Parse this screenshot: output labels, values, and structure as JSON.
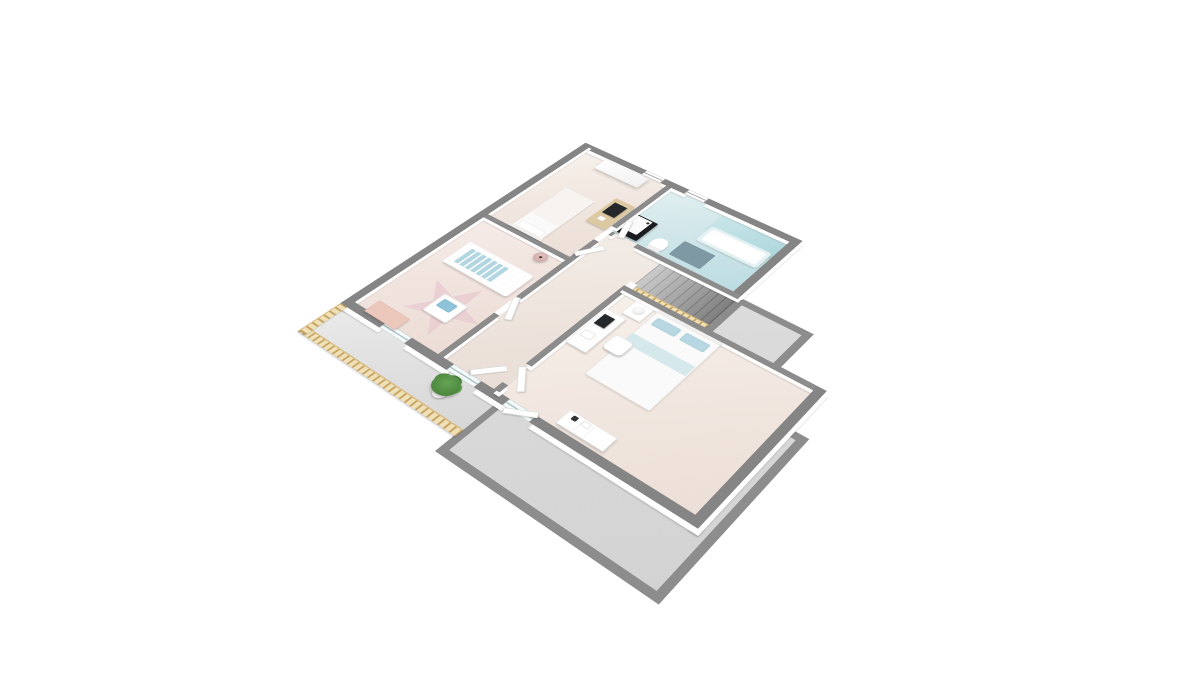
{
  "meta": {
    "description": "3D isometric rendering of an upper-storey floor plan on a white background, rotated ~40 degrees, with gray-topped white walls",
    "background_color": "#ffffff",
    "visible_text": []
  },
  "palette": {
    "wall_top": "#8c8c8c",
    "wall_face": "#ffffff",
    "warm_floor": "#f3e9e2",
    "bathroom_floor": "#c9e2e6",
    "bath_mat": "#7e99a4",
    "glass_screen": "#b8dde2",
    "terrace_floor": "#dedede",
    "railing_wood": "#e8d6ab",
    "rug_pink": "#e9ccd1",
    "bedding_blue": "#b7d8e2",
    "vanity_black": "#1a1c1f",
    "plant_green": "#4c8a3f"
  },
  "rooms": [
    {
      "name": "bedroom-1",
      "position": "top-left",
      "furniture": [
        "single-bed",
        "wardrobe",
        "wood-desk",
        "computer",
        "floor-lamp"
      ]
    },
    {
      "name": "bathroom",
      "position": "top-right",
      "furniture": [
        "bathtub",
        "glass-screen",
        "black-vanity-with-sink",
        "bath-mat",
        "toilet"
      ]
    },
    {
      "name": "nursery",
      "position": "left",
      "furniture": [
        "crib",
        "star-rug",
        "toy-basket",
        "pink-dresser"
      ]
    },
    {
      "name": "landing",
      "position": "center",
      "furniture": [
        "staircase",
        "stair-railing",
        "open-doors"
      ]
    },
    {
      "name": "bedroom-2",
      "position": "bottom-right",
      "furniture": [
        "double-bed",
        "blue-pillows",
        "nightstand",
        "table-lamp",
        "white-desk",
        "desk-chair",
        "sideboard"
      ]
    },
    {
      "name": "balcony",
      "position": "bottom-left",
      "furniture": [
        "wood-railing",
        "potted-plant"
      ]
    },
    {
      "name": "lower-terrace",
      "position": "bottom-right-outside",
      "furniture": []
    }
  ],
  "elements": [
    {
      "k": "terrace-border",
      "name": "terrace-parapet",
      "x": 0,
      "y": 0,
      "w": 680,
      "h": 640
    },
    {
      "k": "terrace-floor",
      "name": "terrace-floor",
      "x": 0,
      "y": 0,
      "w": 680,
      "h": 640
    },
    {
      "k": "floor-balcony",
      "name": "balcony-floor",
      "x": 0,
      "y": 524,
      "w": 302,
      "h": 72
    },
    {
      "k": "floor-warm",
      "name": "bedroom1-floor",
      "x": 14,
      "y": 14,
      "w": 166,
      "h": 232
    },
    {
      "k": "floor-bath",
      "name": "bathroom-floor",
      "x": 190,
      "y": 14,
      "w": 220,
      "h": 146
    },
    {
      "k": "floor-landing",
      "name": "landing-floor",
      "x": 190,
      "y": 160,
      "w": 102,
      "h": 350
    },
    {
      "k": "floor-warm2",
      "name": "nursery-floor",
      "x": 14,
      "y": 246,
      "w": 166,
      "h": 264
    },
    {
      "k": "floor-warm",
      "name": "bedroom2-floor",
      "x": 292,
      "y": 256,
      "w": 308,
      "h": 254
    },
    {
      "k": "stairs",
      "name": "staircase",
      "x": 292,
      "y": 172,
      "w": 132,
      "h": 66
    },
    {
      "k": "rail",
      "name": "stair-railing",
      "x": 292,
      "y": 238,
      "w": 132,
      "h": 9
    },
    {
      "k": "newel",
      "name": "stair-newel-post",
      "x": 284,
      "y": 234,
      "w": 13,
      "h": 14
    },
    {
      "k": "glass",
      "name": "bathtub-glass-screen",
      "x": 296,
      "y": 8,
      "w": 118,
      "h": 54
    },
    {
      "k": "tub",
      "name": "bathtub",
      "x": 298,
      "y": 54,
      "w": 108,
      "h": 44
    },
    {
      "k": "mat",
      "name": "bath-mat",
      "x": 288,
      "y": 110,
      "w": 56,
      "h": 40
    },
    {
      "k": "vanity",
      "name": "vanity-sink",
      "x": 192,
      "y": 102,
      "w": 40,
      "h": 54
    },
    {
      "k": "toilet",
      "name": "toilet",
      "x": 250,
      "y": 126,
      "w": 26,
      "h": 32
    },
    {
      "k": "wall-ext",
      "name": "wall-northeast-1",
      "x": 0,
      "y": 0,
      "w": 130,
      "h": 14
    },
    {
      "k": "window",
      "name": "window-bedroom1",
      "x": 130,
      "y": 0,
      "w": 38,
      "h": 14
    },
    {
      "k": "wall-ext",
      "name": "wall-northeast-2",
      "x": 168,
      "y": 0,
      "w": 47,
      "h": 14
    },
    {
      "k": "window",
      "name": "window-bathroom",
      "x": 215,
      "y": 0,
      "w": 38,
      "h": 14
    },
    {
      "k": "wall-ext",
      "name": "wall-northeast-3",
      "x": 253,
      "y": 0,
      "w": 171,
      "h": 14
    },
    {
      "k": "wall-ext",
      "name": "wall-northwest",
      "x": 0,
      "y": 0,
      "w": 14,
      "h": 524
    },
    {
      "k": "wall-ext",
      "name": "wall-bathroom-southeast",
      "x": 410,
      "y": 14,
      "w": 14,
      "h": 146
    },
    {
      "k": "wall",
      "name": "wall-bathroom-south-1",
      "x": 190,
      "y": 160,
      "w": 6,
      "h": 10
    },
    {
      "k": "wall",
      "name": "wall-bathroom-south-2",
      "x": 238,
      "y": 160,
      "w": 186,
      "h": 10
    },
    {
      "k": "wall",
      "name": "wall-bedroom1-east-1",
      "x": 180,
      "y": 14,
      "w": 10,
      "h": 136
    },
    {
      "k": "wall",
      "name": "wall-bedroom1-east-2",
      "x": 180,
      "y": 192,
      "w": 10,
      "h": 54
    },
    {
      "k": "wall",
      "name": "wall-bedroom1-nursery",
      "x": 14,
      "y": 246,
      "w": 176,
      "h": 10
    },
    {
      "k": "wall",
      "name": "wall-nursery-east-1",
      "x": 180,
      "y": 256,
      "w": 10,
      "h": 104
    },
    {
      "k": "wall",
      "name": "wall-nursery-east-2",
      "x": 180,
      "y": 404,
      "w": 10,
      "h": 106
    },
    {
      "k": "wall-ext",
      "name": "wall-southwest-1",
      "x": 0,
      "y": 510,
      "w": 80,
      "h": 14
    },
    {
      "k": "glassdoor",
      "name": "balcony-glass-door-nursery",
      "x": 80,
      "y": 510,
      "w": 50,
      "h": 14
    },
    {
      "k": "wall-ext",
      "name": "wall-southwest-2",
      "x": 130,
      "y": 510,
      "w": 80,
      "h": 14
    },
    {
      "k": "glassdoor",
      "name": "balcony-glass-door-landing",
      "x": 210,
      "y": 510,
      "w": 50,
      "h": 14
    },
    {
      "k": "wall-ext",
      "name": "wall-southwest-3",
      "x": 260,
      "y": 510,
      "w": 50,
      "h": 14
    },
    {
      "k": "glassdoor",
      "name": "terrace-glass-door-bedroom2",
      "x": 310,
      "y": 510,
      "w": 46,
      "h": 14
    },
    {
      "k": "wall-ext",
      "name": "wall-southwest-4",
      "x": 356,
      "y": 510,
      "w": 258,
      "h": 14
    },
    {
      "k": "wall",
      "name": "wall-bedroom2-west-1",
      "x": 282,
      "y": 256,
      "w": 10,
      "h": 194
    },
    {
      "k": "wall",
      "name": "wall-bedroom2-west-2",
      "x": 282,
      "y": 494,
      "w": 10,
      "h": 16
    },
    {
      "k": "wall",
      "name": "wall-bedroom2-northeast",
      "x": 282,
      "y": 246,
      "w": 332,
      "h": 10
    },
    {
      "k": "wall-ext",
      "name": "wall-bedroom2-southeast",
      "x": 600,
      "y": 246,
      "w": 14,
      "h": 278
    },
    {
      "k": "wardrobe",
      "name": "wardrobe",
      "x": 58,
      "y": 16,
      "w": 88,
      "h": 30
    },
    {
      "k": "bed",
      "name": "single-bed",
      "x": 60,
      "y": 118,
      "w": 58,
      "h": 124
    },
    {
      "k": "duvet",
      "name": "single-bed-duvet",
      "x": 60,
      "y": 118,
      "w": 58,
      "h": 84
    },
    {
      "k": "pillow",
      "name": "single-bed-pillow",
      "x": 66,
      "y": 224,
      "w": 46,
      "h": 14
    },
    {
      "k": "headboard",
      "name": "single-bed-headboard",
      "x": 56,
      "y": 240,
      "w": 66,
      "h": 6
    },
    {
      "k": "desk-wood",
      "name": "wood-desk",
      "x": 140,
      "y": 90,
      "w": 38,
      "h": 74
    },
    {
      "k": "computer",
      "name": "computer",
      "x": 146,
      "y": 100,
      "w": 24,
      "h": 32
    },
    {
      "k": "item-light",
      "name": "desk-mug",
      "x": 150,
      "y": 140,
      "w": 10,
      "h": 8
    },
    {
      "k": "crib",
      "name": "crib",
      "x": 42,
      "y": 312,
      "w": 128,
      "h": 58
    },
    {
      "k": "crib-bedding",
      "name": "crib-bedding",
      "x": 54,
      "y": 322,
      "w": 78,
      "h": 38
    },
    {
      "k": "crib-slats",
      "name": "crib-slats",
      "x": 42,
      "y": 312,
      "w": 128,
      "h": 58
    },
    {
      "k": "lamp",
      "name": "floor-lamp",
      "x": 136,
      "y": 262,
      "w": 22,
      "h": 22
    },
    {
      "k": "star-rug",
      "name": "star-rug",
      "x": 58,
      "y": 378,
      "w": 124,
      "h": 118,
      "rot": 15
    },
    {
      "k": "toy-basket",
      "name": "toy-basket",
      "x": 98,
      "y": 418,
      "w": 42,
      "h": 40
    },
    {
      "k": "toy-blue",
      "name": "toys",
      "x": 106,
      "y": 426,
      "w": 26,
      "h": 18
    },
    {
      "k": "dresser-pink",
      "name": "nursery-dresser",
      "x": 38,
      "y": 486,
      "w": 60,
      "h": 26
    },
    {
      "k": "headboard",
      "name": "double-bed-headboard",
      "x": 352,
      "y": 256,
      "w": 108,
      "h": 8
    },
    {
      "k": "bed",
      "name": "double-bed",
      "x": 354,
      "y": 262,
      "w": 104,
      "h": 152
    },
    {
      "k": "pillow-blue",
      "name": "double-bed-pillow-left",
      "x": 362,
      "y": 270,
      "w": 40,
      "h": 18
    },
    {
      "k": "pillow-blue",
      "name": "double-bed-pillow-right",
      "x": 410,
      "y": 270,
      "w": 40,
      "h": 18
    },
    {
      "k": "throw",
      "name": "double-bed-throw",
      "x": 354,
      "y": 316,
      "w": 104,
      "h": 22
    },
    {
      "k": "nightstand",
      "name": "nightstand",
      "x": 316,
      "y": 262,
      "w": 30,
      "h": 30
    },
    {
      "k": "lamp-white",
      "name": "table-lamp",
      "x": 323,
      "y": 267,
      "w": 16,
      "h": 16
    },
    {
      "k": "desk-white",
      "name": "bedroom2-desk",
      "x": 294,
      "y": 300,
      "w": 34,
      "h": 84
    },
    {
      "k": "computer",
      "name": "desk-lamp-black",
      "x": 300,
      "y": 310,
      "w": 18,
      "h": 24
    },
    {
      "k": "item-light",
      "name": "desk-papers",
      "x": 300,
      "y": 350,
      "w": 16,
      "h": 12
    },
    {
      "k": "chair",
      "name": "desk-chair",
      "x": 338,
      "y": 332,
      "w": 30,
      "h": 30
    },
    {
      "k": "sideboard",
      "name": "sideboard",
      "x": 382,
      "y": 476,
      "w": 74,
      "h": 26
    },
    {
      "k": "item-dark",
      "name": "sideboard-item-dark",
      "x": 392,
      "y": 480,
      "w": 8,
      "h": 8
    },
    {
      "k": "item-light",
      "name": "sideboard-item-light",
      "x": 408,
      "y": 479,
      "w": 10,
      "h": 7
    },
    {
      "k": "rail",
      "name": "balcony-railing",
      "x": 0,
      "y": 584,
      "w": 302,
      "h": 12
    },
    {
      "k": "rail-v",
      "name": "balcony-railing-end",
      "x": 0,
      "y": 524,
      "w": 12,
      "h": 72
    },
    {
      "k": "plant-pot",
      "name": "plant-pot",
      "x": 222,
      "y": 546,
      "w": 20,
      "h": 20
    },
    {
      "k": "plant",
      "name": "plant-foliage",
      "x": 210,
      "y": 526,
      "w": 40,
      "h": 36
    },
    {
      "k": "door",
      "name": "bathroom-door",
      "x": 196,
      "y": 122,
      "w": 9,
      "h": 42,
      "rot": -20
    },
    {
      "k": "door",
      "name": "bedroom1-door",
      "x": 188,
      "y": 194,
      "w": 9,
      "h": 44,
      "rot": 32
    },
    {
      "k": "door",
      "name": "nursery-door",
      "x": 188,
      "y": 358,
      "w": 9,
      "h": 46,
      "rot": -28
    },
    {
      "k": "door",
      "name": "landing-balcony-door",
      "x": 248,
      "y": 466,
      "w": 9,
      "h": 46,
      "rot": 42
    },
    {
      "k": "door",
      "name": "bedroom2-door",
      "x": 292,
      "y": 452,
      "w": 9,
      "h": 44,
      "rot": -40
    },
    {
      "k": "door",
      "name": "bedroom2-terrace-door",
      "x": 314,
      "y": 514,
      "w": 44,
      "h": 8,
      "rot": -28
    }
  ]
}
